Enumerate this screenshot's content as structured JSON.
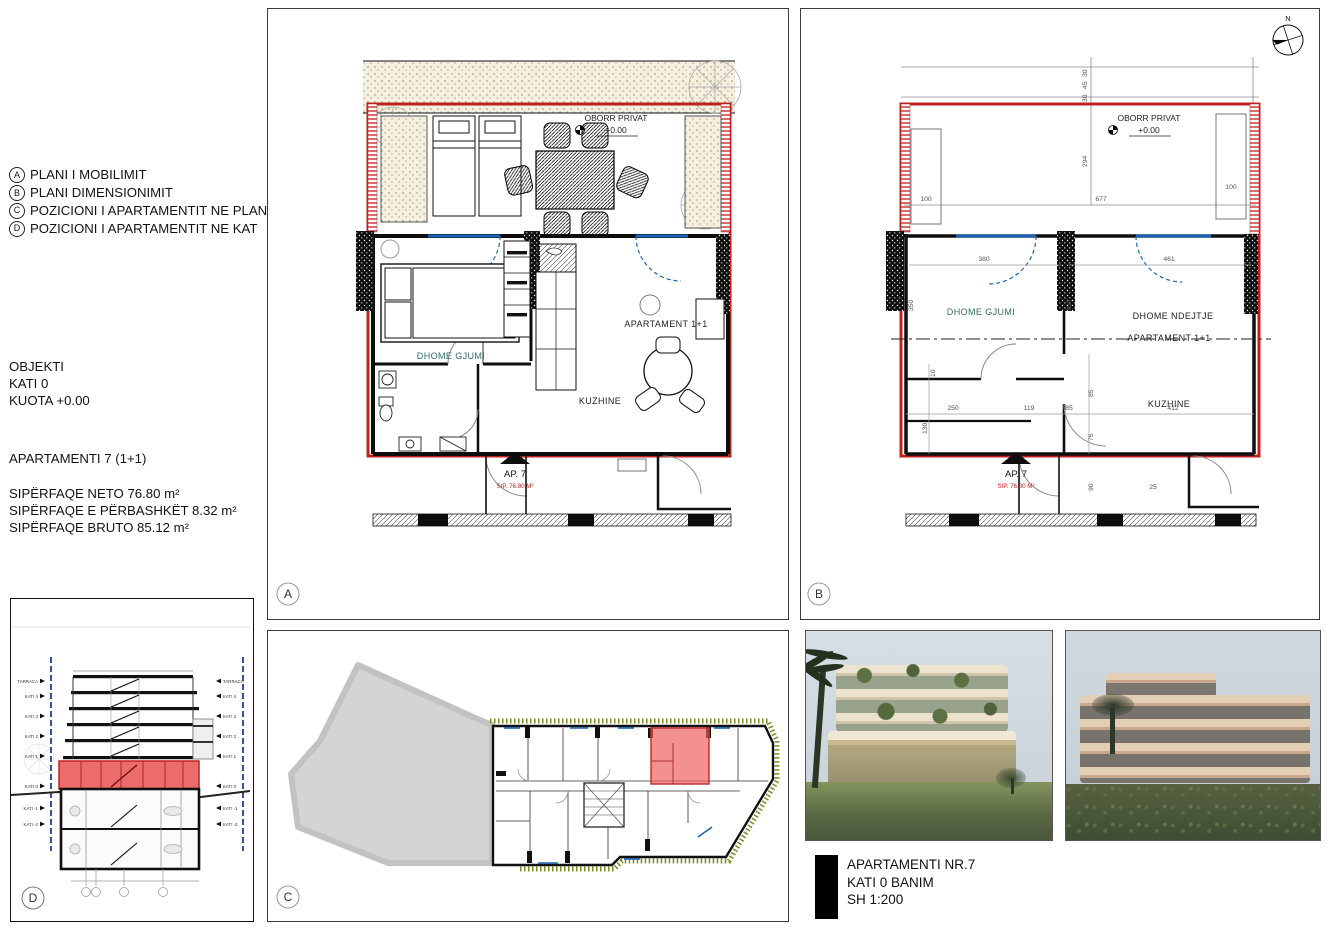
{
  "colors": {
    "boundary_red": "#c0201e",
    "highlight_red": "#e84c4c",
    "window_blue": "#1a63b5",
    "hedge_olive": "#7b8a24",
    "room_teal": "#2f6e60"
  },
  "info_panel": {
    "legend": [
      {
        "key": "A",
        "label": "PLANI I MOBILIMIT"
      },
      {
        "key": "B",
        "label": "PLANI DIMENSIONIMIT"
      },
      {
        "key": "C",
        "label": "POZICIONI I APARTAMENTIT NE PLAN"
      },
      {
        "key": "D",
        "label": "POZICIONI I APARTAMENTIT NE KAT"
      }
    ],
    "object_lines": [
      "OBJEKTI",
      "KATI 0",
      "KUOTA +0.00"
    ],
    "apartment_title": "APARTAMENTI 7 (1+1)",
    "area_lines": [
      "SIPËRFAQE NETO 76.80 m²",
      "SIPËRFAQE E PËRBASHKËT 8.32 m²",
      "SIPËRFAQE BRUTO 85.12 m²"
    ]
  },
  "plan_a": {
    "panel_label": "A",
    "courtyard": {
      "label": "OBORR PRIVAT",
      "level": "+0.00"
    },
    "rooms": {
      "bedroom": "DHOME GJUMI",
      "apartment": "APARTAMENT 1+1",
      "kitchen": "KUZHINE"
    },
    "tag": {
      "name": "AP. 7",
      "area": "SIP. 76.80 M²"
    }
  },
  "plan_b": {
    "panel_label": "B",
    "north_label": "N",
    "courtyard": {
      "label": "OBORR PRIVAT",
      "level": "+0.00"
    },
    "rooms": {
      "bedroom": "DHOME GJUMI",
      "living": "DHOME NDEJTJE",
      "apartment": "APARTAMENT 1+1",
      "kitchen": "KUZHINE"
    },
    "tag": {
      "name": "AP. 7",
      "area": "SIP. 76.80 M²"
    },
    "dims": {
      "top_a": "30",
      "top_b": "45",
      "top_c": "30",
      "courtyard_depth": "294",
      "planter_left": "100",
      "courtyard_width": "677",
      "planter_right": "100",
      "bedroom_width": "380",
      "living_width": "461",
      "bedroom_height": "350",
      "room_height": "360",
      "hall": "250",
      "entry": "119",
      "niche": "85",
      "kitchen_width": "412",
      "step": "25",
      "wc": "130",
      "jamb": "10",
      "corridor": "90",
      "shaft": "75"
    }
  },
  "panel_c": {
    "panel_label": "C"
  },
  "panel_d": {
    "panel_label": "D",
    "levels_upper": [
      "TARRACA",
      "KATI 4",
      "KATI 3",
      "KATI 2",
      "KATI 1"
    ],
    "level_ground": "KATI 0",
    "levels_lower": [
      "KATI -1",
      "KATI -2"
    ]
  },
  "title_block": {
    "line1": "APARTAMENTI NR.7",
    "line2": "KATI 0 BANIM",
    "line3": "SH 1:200"
  }
}
